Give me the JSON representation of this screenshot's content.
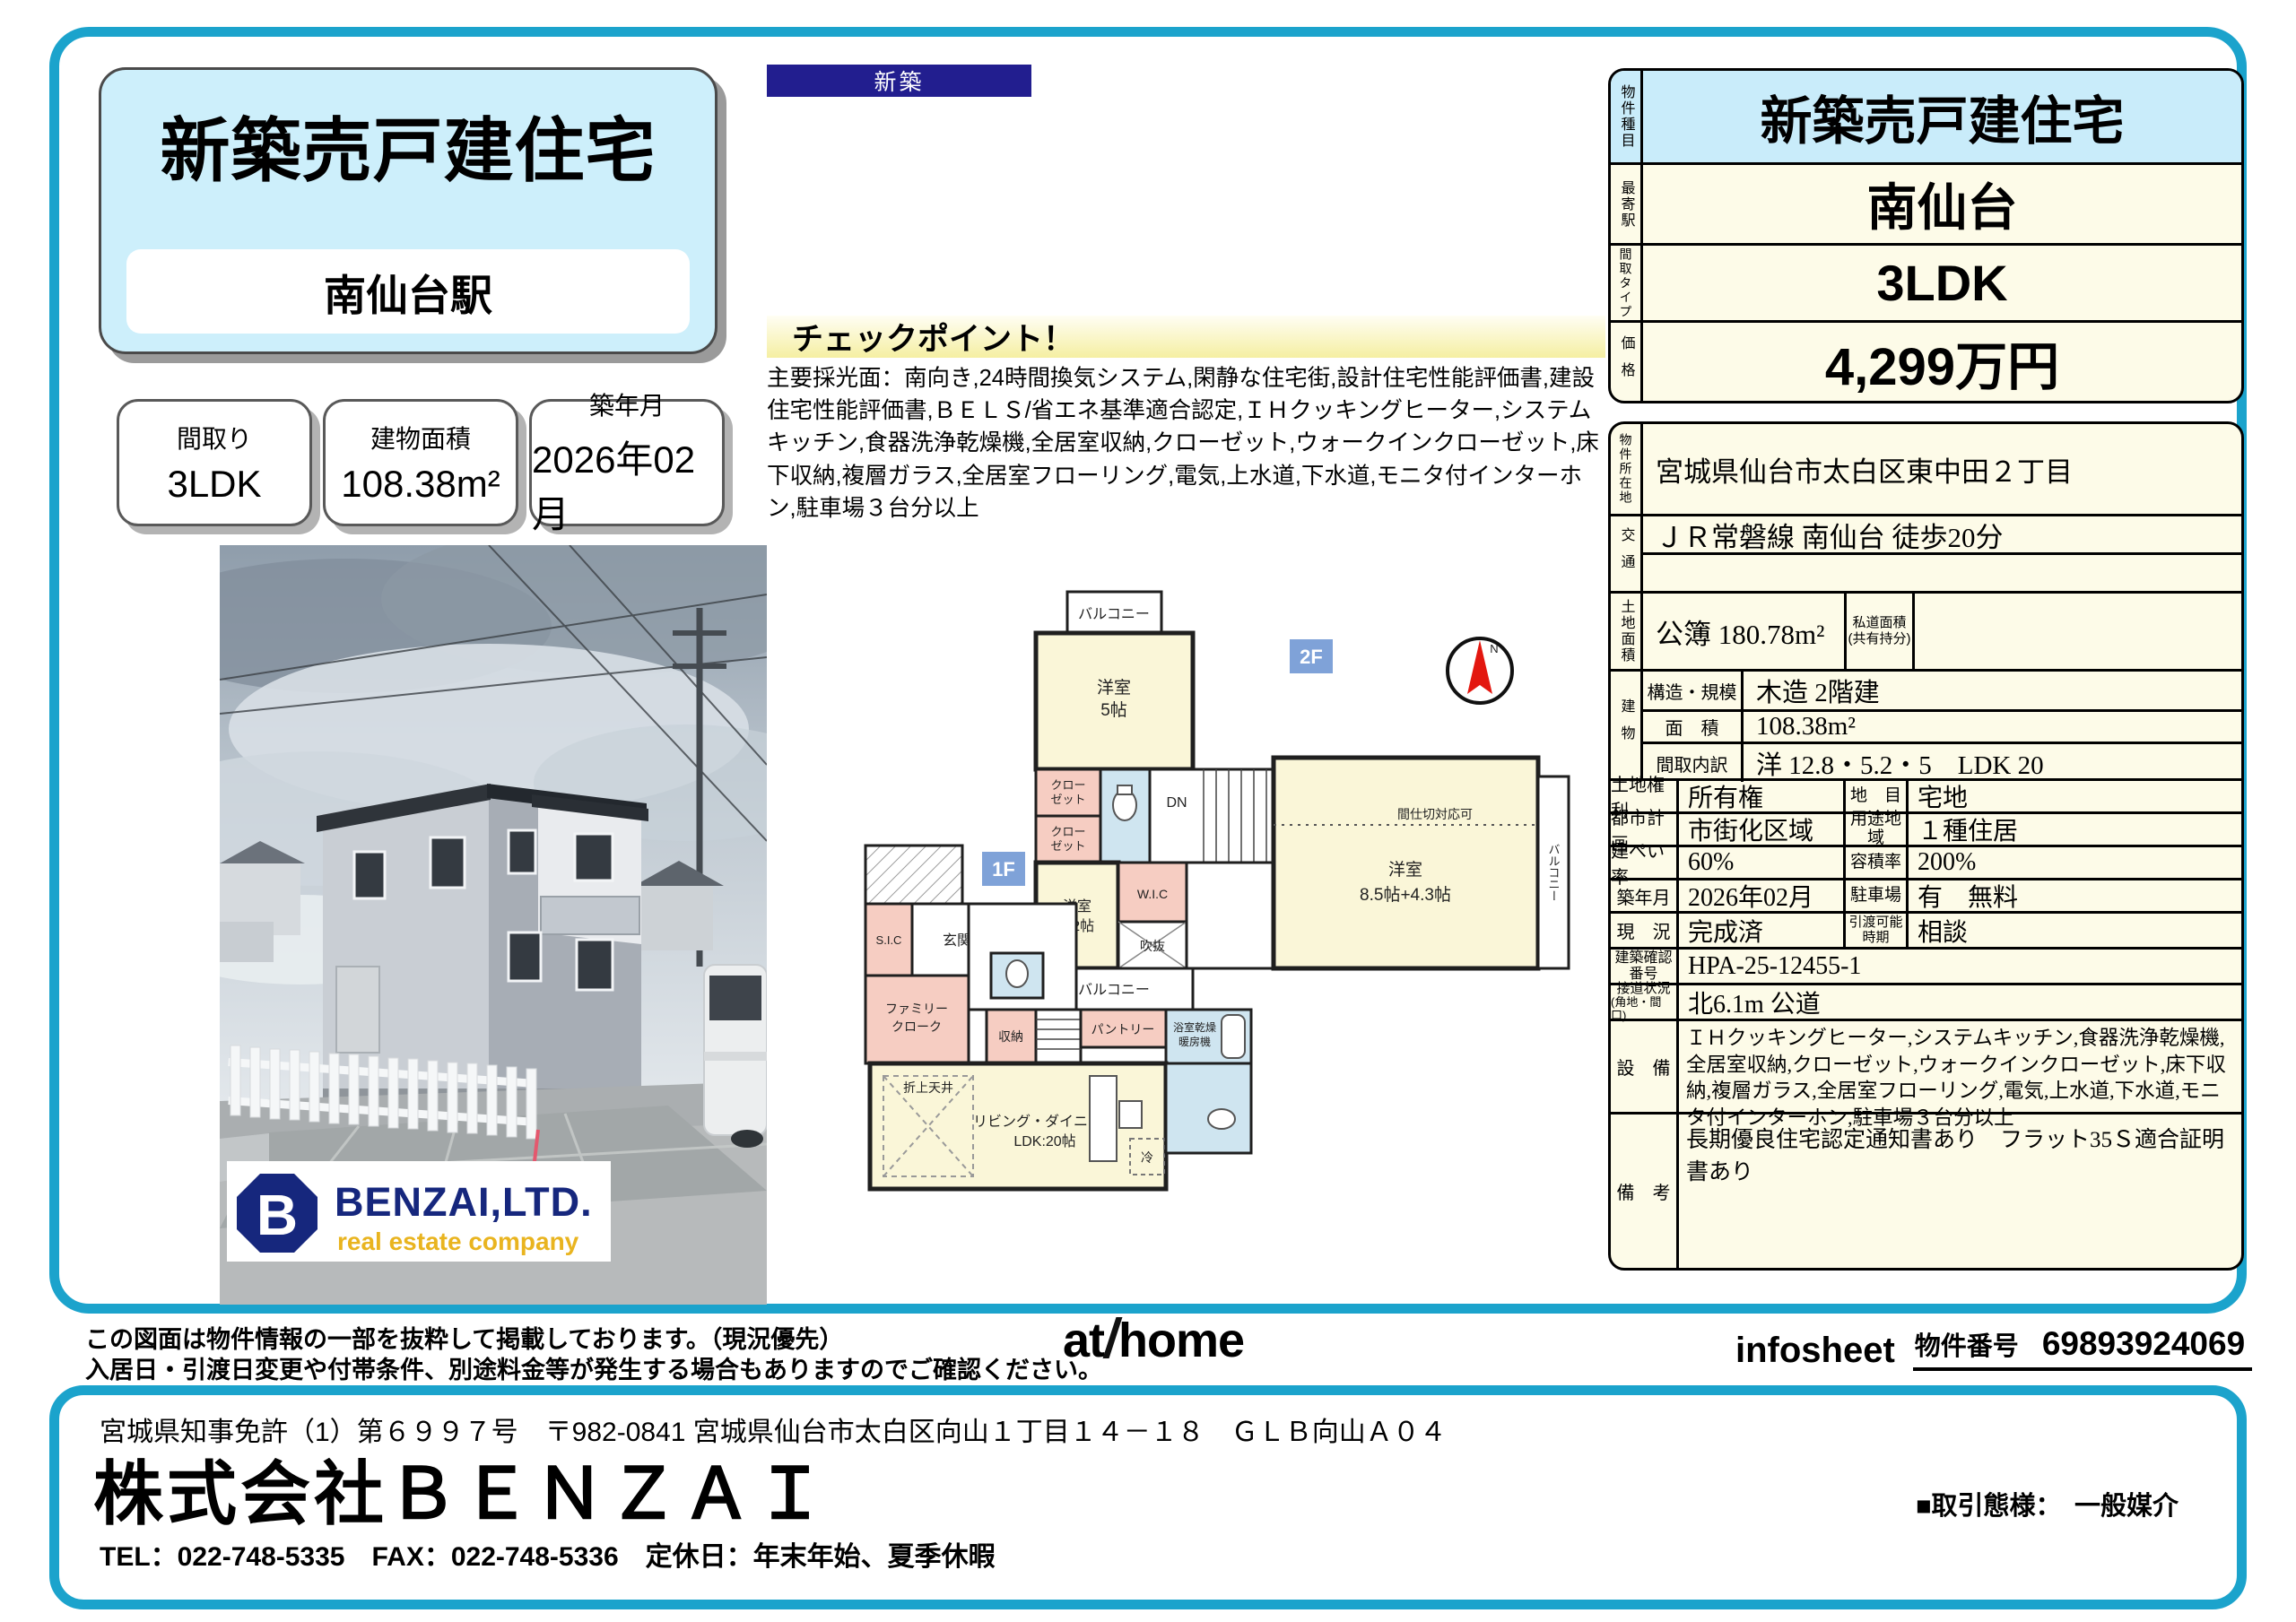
{
  "colors": {
    "frame_teal": "#1ba3cc",
    "badge_navy": "#221e8f",
    "table_cream": "#fdfbe8",
    "table_light_blue": "#c9ecfa",
    "floor_badge_blue": "#7fa2d8",
    "logo_navy": "#16277d",
    "logo_gold": "#e9b41f",
    "compass_red": "#e3170f"
  },
  "header": {
    "new_badge": "新築",
    "title": "新築売戸建住宅",
    "station": "南仙台駅"
  },
  "quick_facts": [
    {
      "label": "間取り",
      "value": "3LDK"
    },
    {
      "label": "建物面積",
      "value": "108.38m²"
    },
    {
      "label": "築年月",
      "value": "2026年02月"
    }
  ],
  "checkpoint": {
    "title": "チェックポイント！",
    "body": "主要採光面：南向き,24時間換気システム,閑静な住宅街,設計住宅性能評価書,建設住宅性能評価書,ＢＥＬＳ/省エネ基準適合認定,ＩＨクッキングヒーター,システムキッチン,食器洗浄乾燥機,全居室収納,クローゼット,ウォークインクローゼット,床下収納,複層ガラス,全居室フローリング,電気,上水道,下水道,モニタ付インターホン,駐車場３台分以上"
  },
  "photo": {
    "logo_initial": "B",
    "logo_name": "BENZAI,LTD.",
    "logo_tagline": "real estate company"
  },
  "floorplan": {
    "floor2": "2F",
    "floor1": "1F",
    "north": "N",
    "balcony": "バルコニー",
    "room5_l1": "洋室",
    "room5_l2": "5帖",
    "closet_l1": "クロー",
    "closet_l2": "ゼット",
    "dn": "DN",
    "room52_l1": "洋室",
    "room52_l2": "5.2帖",
    "wic": "W.I.C",
    "void": "吹抜",
    "room85_l1": "洋室",
    "room85_l2": "8.5帖+4.3帖",
    "partition": "間仕切対応可",
    "sic": "S.I.C",
    "genkan": "玄関",
    "family_l1": "ファミリー",
    "family_l2": "クローク",
    "storage": "収納",
    "up": "UP",
    "pantry": "パントリー",
    "bath_l1": "浴室乾燥",
    "bath_l2": "暖房機",
    "oriage": "折上天井",
    "living_l1": "リビング・ダイニング",
    "living_l2": "LDK:20帖",
    "fridge": "冷"
  },
  "spec_top": {
    "rows": [
      {
        "label": "物件種目",
        "value": "新築売戸建住宅"
      },
      {
        "label": "最寄駅",
        "value": "南仙台"
      },
      {
        "label": "間取タイプ",
        "value": "3LDK"
      },
      {
        "label": "価格",
        "value": "4,299万円"
      }
    ]
  },
  "spec_main": {
    "location_label": "物件所在地",
    "location": "宮城県仙台市太白区東中田２丁目",
    "access_label": "交通",
    "access": "ＪＲ常磐線 南仙台 徒歩20分",
    "land_label": "土地面積",
    "land": "公簿 180.78m²",
    "private_road_l1": "私道面積",
    "private_road_l2": "(共有持分)",
    "building_label": "建物",
    "building_rows": [
      {
        "label": "構造・規模",
        "value": "木造 2階建"
      },
      {
        "label": "面　積",
        "value": "108.38m²"
      },
      {
        "label": "間取内訳",
        "value": "洋 12.8・5.2・5　LDK 20"
      }
    ],
    "pair_rows": [
      {
        "l1": "土地権利",
        "v1": "所有権",
        "l2": "地　目",
        "v2": "宅地"
      },
      {
        "l1": "都市計画",
        "v1": "市街化区域",
        "l2": "用途地域",
        "v2": "１種住居"
      },
      {
        "l1": "建ぺい率",
        "v1": "60%",
        "l2": "容積率",
        "v2": "200%"
      },
      {
        "l1": "築年月",
        "v1": "2026年02月",
        "l2": "駐車場",
        "v2": "有　無料"
      },
      {
        "l1": "現　況",
        "v1": "完成済",
        "l2": "引渡可能時期",
        "v2": "相談"
      }
    ],
    "confirm_label_l1": "建築確認",
    "confirm_label_l2": "番号",
    "confirm_no": "HPA-25-12455-1",
    "road_label_l1": "接道状況",
    "road_label_l2": "(角地・間口)",
    "road": "北6.1m 公道",
    "equip_label": "設　備",
    "equipment": "ＩＨクッキングヒーター,システムキッチン,食器洗浄乾燥機,全居室収納,クローゼット,ウォークインクローゼット,床下収納,複層ガラス,全居室フローリング,電気,上水道,下水道,モニタ付インターホン,駐車場３台分以上",
    "remarks_label": "備　考",
    "remarks": "長期優良住宅認定通知書あり　フラット35Ｓ適合証明書あり"
  },
  "footer": {
    "disclaimer1": "この図面は物件情報の一部を抜粋して掲載しております。（現況優先）",
    "disclaimer2": "入居日・引渡日変更や付帯条件、別途料金等が発生する場合もありますのでご確認ください。",
    "athome_at": "at",
    "athome_home": "home",
    "infosheet": "infosheet",
    "property_no_label": "物件番号",
    "property_no": "69893924069"
  },
  "company": {
    "license": "宮城県知事免許（1）第６９９７号　〒982-0841 宮城県仙台市太白区向山１丁目１４－１８　ＧＬＢ向山Ａ０４",
    "name": "株式会社ＢＥＮＺＡＩ",
    "contact": "TEL：022-748-5335　FAX：022-748-5336　定休日：年末年始、夏季休暇",
    "deal_type": "■取引態様：　一般媒介"
  }
}
